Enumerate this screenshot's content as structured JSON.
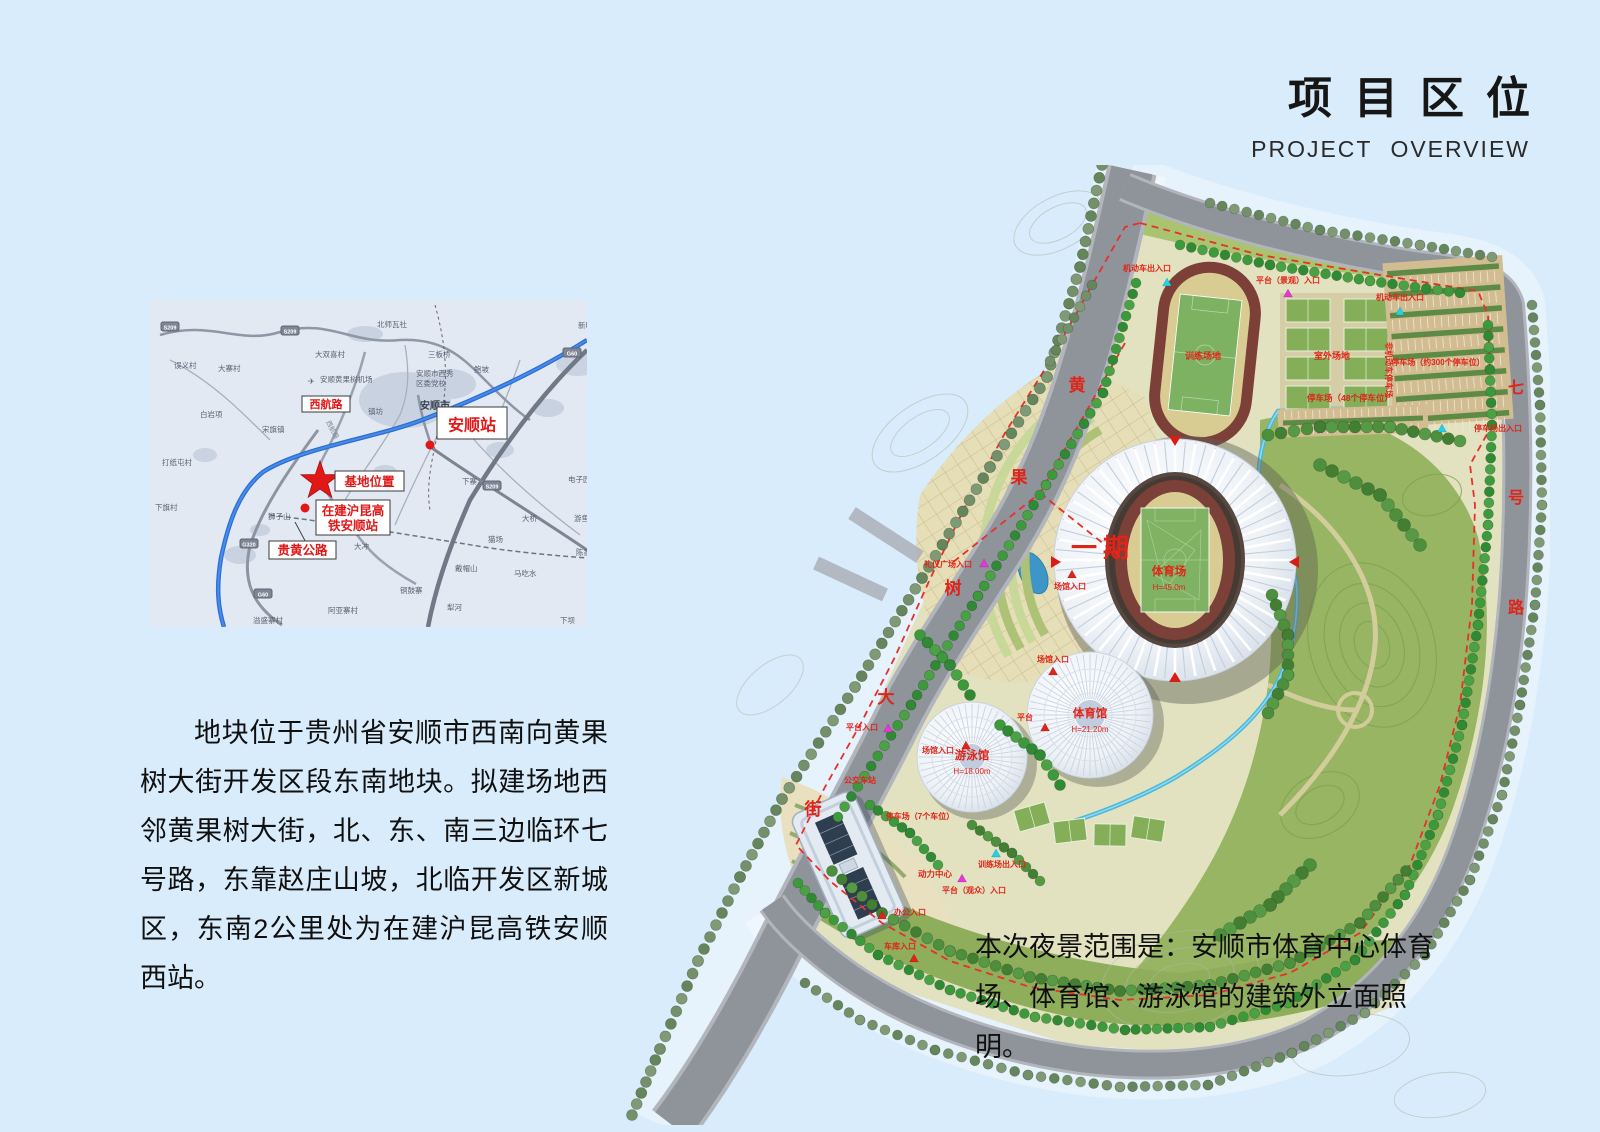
{
  "header": {
    "title": "项目区位",
    "subtitle": "PROJECT OVERVIEW"
  },
  "description": {
    "text": "地块位于贵州省安顺市西南向黄果树大街开发区段东南地块。拟建场地西邻黄果树大街，北、东、南三边临环七号路，东靠赵庄山坡，北临开发区新城区，东南2公里处为在建沪昆高铁安顺西站。"
  },
  "night_scope": {
    "text": "本次夜景范围是：安顺市体育中心体育场、体育馆、游泳馆的建筑外立面照明。"
  },
  "location_map": {
    "callouts": [
      {
        "id": "xihanglu",
        "lines": [
          "西航路"
        ],
        "x": 152,
        "y": 96,
        "w": 48,
        "h": 16,
        "fs": 11
      },
      {
        "id": "anshun-station",
        "lines": [
          "安顺站"
        ],
        "x": 287,
        "y": 107,
        "w": 70,
        "h": 32,
        "fs": 16
      },
      {
        "id": "site-location",
        "lines": [
          "基地位置"
        ],
        "x": 185,
        "y": 171,
        "w": 69,
        "h": 20,
        "fs": 12.5
      },
      {
        "id": "hsr-station",
        "lines": [
          "在建沪昆高",
          "铁安顺站"
        ],
        "x": 166,
        "y": 200,
        "w": 74,
        "h": 35,
        "fs": 12.5
      },
      {
        "id": "guihuang-road",
        "lines": [
          "贵黄公路"
        ],
        "x": 119,
        "y": 241,
        "w": 67,
        "h": 18,
        "fs": 12.5
      }
    ],
    "star": {
      "x": 170,
      "y": 181,
      "label": "基地位置"
    },
    "dots": [
      {
        "x": 280,
        "y": 145
      },
      {
        "x": 155,
        "y": 208
      }
    ],
    "badges": [
      {
        "t": "S209",
        "x": 20,
        "y": 27
      },
      {
        "t": "S209",
        "x": 140,
        "y": 31
      },
      {
        "t": "G60",
        "x": 422,
        "y": 53
      },
      {
        "t": "S209",
        "x": 342,
        "y": 186
      },
      {
        "t": "G320",
        "x": 99,
        "y": 244
      },
      {
        "t": "G60",
        "x": 113,
        "y": 294
      }
    ],
    "places": [
      {
        "t": "北师瓦社",
        "x": 227,
        "y": 27
      },
      {
        "t": "新明村",
        "x": 428,
        "y": 28
      },
      {
        "t": "大双喜村",
        "x": 165,
        "y": 57
      },
      {
        "t": "三板桥",
        "x": 278,
        "y": 57
      },
      {
        "t": "误义村",
        "x": 24,
        "y": 68
      },
      {
        "t": "大寨村",
        "x": 68,
        "y": 71
      },
      {
        "t": "安顺黄果树机场",
        "x": 170,
        "y": 82
      },
      {
        "t": "鲍坡",
        "x": 324,
        "y": 72
      },
      {
        "t": "安顺市西秀",
        "x": 266,
        "y": 76
      },
      {
        "t": "区委党校",
        "x": 266,
        "y": 86
      },
      {
        "t": "白岩项",
        "x": 50,
        "y": 117
      },
      {
        "t": "宋旗镇",
        "x": 112,
        "y": 132
      },
      {
        "t": "镇坊",
        "x": 218,
        "y": 114
      },
      {
        "t": "打纸屯村",
        "x": 12,
        "y": 165
      },
      {
        "t": "下旗村",
        "x": 5,
        "y": 210
      },
      {
        "t": "狮子山",
        "x": 118,
        "y": 219
      },
      {
        "t": "下寨",
        "x": 312,
        "y": 184
      },
      {
        "t": "电子园",
        "x": 418,
        "y": 182
      },
      {
        "t": "大桥",
        "x": 372,
        "y": 221
      },
      {
        "t": "游鱼井",
        "x": 424,
        "y": 221
      },
      {
        "t": "猫场",
        "x": 338,
        "y": 242
      },
      {
        "t": "陈家山脚",
        "x": 426,
        "y": 255
      },
      {
        "t": "戴帽山",
        "x": 305,
        "y": 271
      },
      {
        "t": "马吃水",
        "x": 364,
        "y": 276
      },
      {
        "t": "铜鼓寨",
        "x": 250,
        "y": 293
      },
      {
        "t": "阿亚寨村",
        "x": 178,
        "y": 313
      },
      {
        "t": "犁河",
        "x": 297,
        "y": 310
      },
      {
        "t": "大冲",
        "x": 204,
        "y": 249
      },
      {
        "t": "溢盛寨村",
        "x": 103,
        "y": 323
      },
      {
        "t": "下坝",
        "x": 410,
        "y": 323
      }
    ],
    "city": {
      "t": "安顺市",
      "x": 270,
      "y": 109
    },
    "road_on_map": {
      "t": "西航路",
      "x": 176,
      "y": 122,
      "rot": 62
    }
  },
  "site_plan": {
    "phase": {
      "t": "一期",
      "x": 483,
      "y": 392
    },
    "street_chars": [
      {
        "c": "黄",
        "x": 457,
        "y": 226
      },
      {
        "c": "果",
        "x": 399,
        "y": 318
      },
      {
        "c": "树",
        "x": 333,
        "y": 429
      },
      {
        "c": "大",
        "x": 266,
        "y": 538
      },
      {
        "c": "街",
        "x": 193,
        "y": 650
      }
    ],
    "ring_chars": [
      {
        "c": "七",
        "x": 896,
        "y": 228
      },
      {
        "c": "号",
        "x": 896,
        "y": 338
      },
      {
        "c": "路",
        "x": 896,
        "y": 448
      }
    ],
    "venues": [
      {
        "name": "体育场",
        "height": "H=45.0m",
        "x": 549,
        "y": 410
      },
      {
        "name": "体育馆",
        "height": "H=21.20m",
        "x": 470,
        "y": 552
      },
      {
        "name": "游泳馆",
        "height": "H=18.00m",
        "x": 352,
        "y": 594
      }
    ],
    "area_labels": [
      {
        "t": "训练场地",
        "x": 583,
        "y": 194,
        "fs": 9
      },
      {
        "t": "室外场地",
        "x": 712,
        "y": 194,
        "fs": 9
      },
      {
        "t": "停车场（48个停车位）",
        "x": 730,
        "y": 236,
        "fs": 8.5
      },
      {
        "t": "停车场（约300个停车位）",
        "x": 818,
        "y": 200,
        "fs": 8
      },
      {
        "t": "非机动车停车场",
        "x": 766,
        "y": 205,
        "fs": 8,
        "rot": 90
      },
      {
        "t": "停车场（7个车位）",
        "x": 300,
        "y": 654,
        "fs": 8
      },
      {
        "t": "动力中心",
        "x": 315,
        "y": 712,
        "fs": 8.5
      }
    ],
    "entrances": [
      {
        "t": "机动车出入口",
        "x": 527,
        "y": 106,
        "m": "cyan",
        "mp": [
          20,
          12
        ]
      },
      {
        "t": "平台（景观）入口",
        "x": 668,
        "y": 118,
        "m": "magenta",
        "mp": [
          0,
          11
        ]
      },
      {
        "t": "机动车出入口",
        "x": 780,
        "y": 135,
        "m": "cyan",
        "mp": [
          0,
          12
        ]
      },
      {
        "t": "停车场出入口",
        "x": 878,
        "y": 266,
        "m": "cyan",
        "mp": [
          -56,
          -2
        ]
      },
      {
        "t": "礼仪广场入口",
        "x": 328,
        "y": 402,
        "m": "magenta",
        "mp": [
          36,
          -3
        ]
      },
      {
        "t": "场馆入口",
        "x": 450,
        "y": 424,
        "m": "red",
        "mp": [
          2,
          -14
        ]
      },
      {
        "t": "场馆入口",
        "x": 433,
        "y": 497,
        "m": "red",
        "mp": [
          0,
          10
        ]
      },
      {
        "t": "场馆入口",
        "x": 318,
        "y": 588,
        "m": "red",
        "mp": [
          28,
          -7
        ]
      },
      {
        "t": "平台",
        "x": 405,
        "y": 555,
        "m": "red",
        "mp": [
          20,
          8
        ]
      },
      {
        "t": "平台入口",
        "x": 242,
        "y": 565,
        "m": "magenta",
        "mp": [
          26,
          -1
        ]
      },
      {
        "t": "公交车站",
        "x": 240,
        "y": 618,
        "m": "none",
        "mp": [
          0,
          0
        ]
      },
      {
        "t": "训练场出入口",
        "x": 382,
        "y": 702,
        "m": "cyan",
        "mp": [
          -6,
          -13
        ]
      },
      {
        "t": "平台（观众）入口",
        "x": 354,
        "y": 728,
        "m": "magenta",
        "mp": [
          -12,
          -14
        ]
      },
      {
        "t": "办公入口",
        "x": 290,
        "y": 750,
        "m": "red",
        "mp": [
          -28,
          1
        ]
      },
      {
        "t": "车库入口",
        "x": 280,
        "y": 784,
        "m": "red",
        "mp": [
          14,
          10
        ]
      }
    ],
    "colors": {
      "label": "#e02418",
      "boundary": "#e8302a",
      "water": "#49b8dc",
      "cyan": "#1fd2e8",
      "magenta": "#e836d8",
      "red": "#e02418"
    }
  }
}
